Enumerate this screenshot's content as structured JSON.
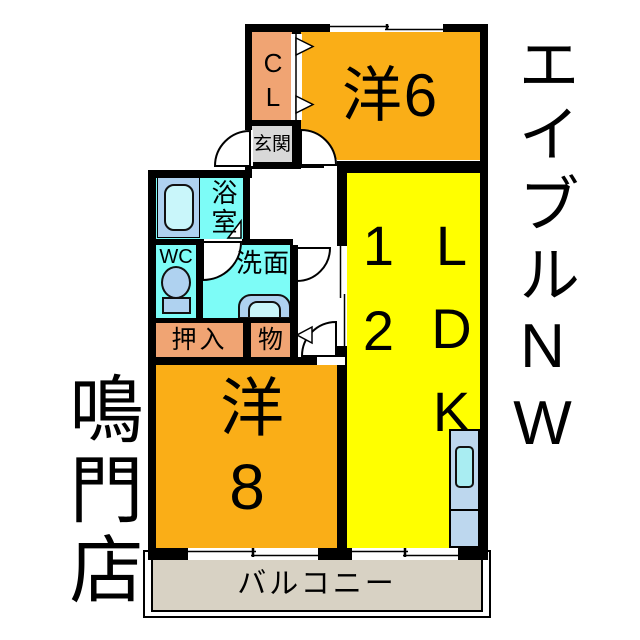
{
  "floorplan": {
    "rooms": {
      "closet_cl": {
        "label": "CL"
      },
      "entry": {
        "label": "玄関"
      },
      "western6": {
        "label": "洋6"
      },
      "bath": {
        "label": "浴室"
      },
      "wc": {
        "label": "WC"
      },
      "washroom": {
        "label": "洗面"
      },
      "oshiire": {
        "label": "押入"
      },
      "storage": {
        "label": "物"
      },
      "western8": {
        "label": "洋8"
      },
      "ldk": {
        "size": "12",
        "label": "LDK"
      },
      "balcony": {
        "label": "バルコニー"
      }
    },
    "colors": {
      "wall": "#000000",
      "room_orange": "#FAAE17",
      "closet_salmon": "#F0A473",
      "entry_gray": "#D8D8D8",
      "wet_cyan": "#7DFCF7",
      "fixture_blue": "#AFD2F0",
      "fixture_inner": "#C9F6FA",
      "ldk_yellow": "#FFFF00",
      "counter_blue": "#BDD7EE",
      "counter_sink": "#A9EDF2",
      "balcony_beige": "#D8D2C4"
    }
  },
  "annotations": {
    "company_vertical": "エイブルNW",
    "branch_vertical": "鳴門店"
  }
}
